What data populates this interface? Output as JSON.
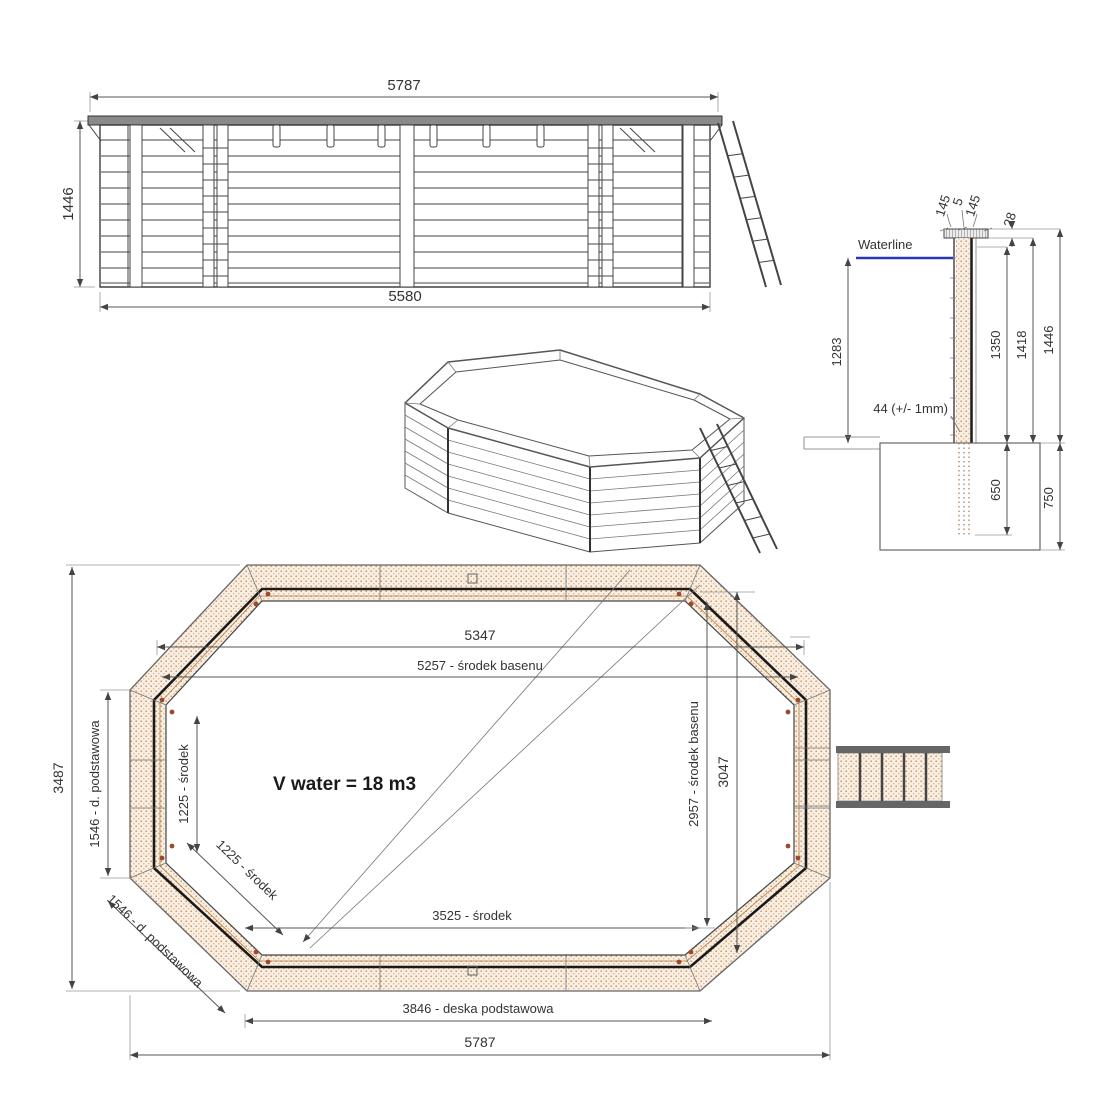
{
  "title": "Octagonal wooden pool technical drawing",
  "colors": {
    "waterline_blue": "#2a35b8",
    "wood_dot": "#cf8a52",
    "line_gray": "#555555",
    "text_dark": "#333333"
  },
  "views": {
    "elevation": {
      "dim_width_top": "5787",
      "dim_height_left": "1446",
      "dim_width_bottom": "5580"
    },
    "cross_section": {
      "dim_cap_left": "145",
      "dim_cap_gap": "5",
      "dim_cap_right": "145",
      "dim_cap_thickness": "28",
      "waterline_label": "Waterline",
      "dim_waterline_height": "1283",
      "dim_wall_inner": "1350",
      "dim_wall_mid": "1418",
      "dim_wall_total": "1446",
      "wall_thickness_label": "44 (+/- 1mm)",
      "dim_post_embed": "650",
      "dim_foundation_depth": "750"
    },
    "plan": {
      "dim_outer_width_corners": "5347",
      "dim_center_width": "5257 - środek basenu",
      "dim_overall_height": "3487",
      "dim_side_left": "1546 - d. podstawowa",
      "dim_left_inner": "1225 - środek",
      "dim_corner_inner": "1225 - środek",
      "dim_corner_outer": "1546 - d. podstawowa",
      "volume_label": "V water = 18 m3",
      "dim_inner_width": "3525 - środek",
      "dim_center_height": "2957 - środek basenu",
      "dim_inner_height": "3047",
      "dim_base_board": "3846 - deska podstawowa",
      "dim_overall_width": "5787"
    }
  }
}
